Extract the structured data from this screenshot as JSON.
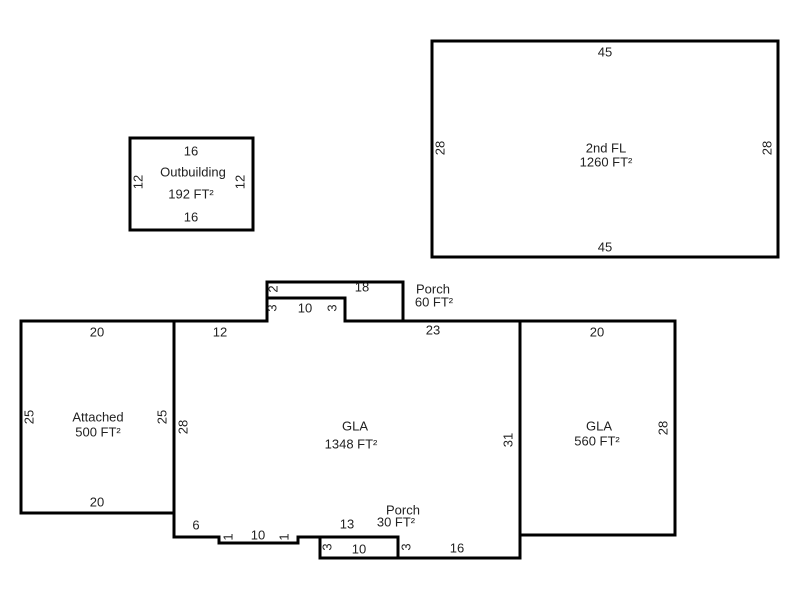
{
  "sketch": {
    "canvas": {
      "width": 800,
      "height": 600,
      "background": "#ffffff"
    },
    "style": {
      "wall_color": "#000000",
      "wall_width": 3,
      "text_color": "#222222",
      "font_size": 13
    },
    "shapes": [
      {
        "id": "second-floor",
        "room_name": "2nd FL",
        "area": "1260 FT²",
        "points": [
          [
            432,
            41
          ],
          [
            778,
            41
          ],
          [
            778,
            257
          ],
          [
            432,
            257
          ]
        ],
        "labels": [
          {
            "text": "45",
            "x": 605,
            "y": 52,
            "rotated": false,
            "kind": "dimension"
          },
          {
            "text": "28",
            "x": 440,
            "y": 148,
            "rotated": true,
            "kind": "dimension"
          },
          {
            "text": "2nd FL",
            "x": 606,
            "y": 148,
            "rotated": false,
            "kind": "room"
          },
          {
            "text": "1260 FT²",
            "x": 606,
            "y": 162,
            "rotated": false,
            "kind": "area"
          },
          {
            "text": "28",
            "x": 767,
            "y": 148,
            "rotated": true,
            "kind": "dimension"
          },
          {
            "text": "45",
            "x": 605,
            "y": 247,
            "rotated": false,
            "kind": "dimension"
          }
        ]
      },
      {
        "id": "outbuilding",
        "room_name": "Outbuilding",
        "area": "192 FT²",
        "points": [
          [
            130,
            138
          ],
          [
            253,
            138
          ],
          [
            253,
            230
          ],
          [
            130,
            230
          ]
        ],
        "labels": [
          {
            "text": "16",
            "x": 191,
            "y": 151,
            "rotated": false,
            "kind": "dimension"
          },
          {
            "text": "12",
            "x": 138,
            "y": 182,
            "rotated": true,
            "kind": "dimension"
          },
          {
            "text": "Outbuilding",
            "x": 193,
            "y": 172,
            "rotated": false,
            "kind": "room"
          },
          {
            "text": "192 FT²",
            "x": 191,
            "y": 194,
            "rotated": false,
            "kind": "area"
          },
          {
            "text": "12",
            "x": 240,
            "y": 182,
            "rotated": true,
            "kind": "dimension"
          },
          {
            "text": "16",
            "x": 191,
            "y": 217,
            "rotated": false,
            "kind": "dimension"
          }
        ]
      },
      {
        "id": "attached",
        "room_name": "Attached",
        "area": "500 FT²",
        "points": [
          [
            21,
            321
          ],
          [
            174,
            321
          ],
          [
            174,
            513
          ],
          [
            21,
            513
          ]
        ],
        "labels": [
          {
            "text": "20",
            "x": 97,
            "y": 332,
            "rotated": false,
            "kind": "dimension"
          },
          {
            "text": "25",
            "x": 29,
            "y": 417,
            "rotated": true,
            "kind": "dimension"
          },
          {
            "text": "Attached",
            "x": 98,
            "y": 417,
            "rotated": false,
            "kind": "room"
          },
          {
            "text": "500 FT²",
            "x": 98,
            "y": 432,
            "rotated": false,
            "kind": "area"
          },
          {
            "text": "25",
            "x": 162,
            "y": 417,
            "rotated": true,
            "kind": "dimension"
          },
          {
            "text": "20",
            "x": 97,
            "y": 502,
            "rotated": false,
            "kind": "dimension"
          }
        ]
      },
      {
        "id": "gla-main",
        "room_name": "GLA",
        "area": "1348 FT²",
        "points": [
          [
            174,
            321
          ],
          [
            267,
            321
          ],
          [
            267,
            298
          ],
          [
            345,
            298
          ],
          [
            345,
            321
          ],
          [
            520,
            321
          ],
          [
            520,
            558
          ],
          [
            398,
            558
          ],
          [
            398,
            537
          ],
          [
            298,
            537
          ],
          [
            298,
            543
          ],
          [
            219,
            543
          ],
          [
            219,
            537
          ],
          [
            174,
            537
          ]
        ],
        "labels": [
          {
            "text": "12",
            "x": 220,
            "y": 332,
            "rotated": false,
            "kind": "dimension"
          },
          {
            "text": "23",
            "x": 433,
            "y": 330,
            "rotated": false,
            "kind": "dimension"
          },
          {
            "text": "28",
            "x": 183,
            "y": 427,
            "rotated": true,
            "kind": "dimension"
          },
          {
            "text": "GLA",
            "x": 355,
            "y": 426,
            "rotated": false,
            "kind": "room"
          },
          {
            "text": "1348 FT²",
            "x": 351,
            "y": 444,
            "rotated": false,
            "kind": "area"
          },
          {
            "text": "31",
            "x": 508,
            "y": 440,
            "rotated": true,
            "kind": "dimension"
          },
          {
            "text": "6",
            "x": 196,
            "y": 525,
            "rotated": false,
            "kind": "dimension"
          },
          {
            "text": "1",
            "x": 228,
            "y": 537,
            "rotated": true,
            "kind": "dimension"
          },
          {
            "text": "10",
            "x": 258,
            "y": 535,
            "rotated": false,
            "kind": "dimension"
          },
          {
            "text": "1",
            "x": 284,
            "y": 537,
            "rotated": true,
            "kind": "dimension"
          },
          {
            "text": "13",
            "x": 347,
            "y": 524,
            "rotated": false,
            "kind": "dimension"
          },
          {
            "text": "3",
            "x": 406,
            "y": 547,
            "rotated": true,
            "kind": "dimension"
          },
          {
            "text": "16",
            "x": 457,
            "y": 548,
            "rotated": false,
            "kind": "dimension"
          }
        ]
      },
      {
        "id": "porch-top",
        "room_name": "Porch",
        "area": "60 FT²",
        "points": [
          [
            267,
            298
          ],
          [
            267,
            282
          ],
          [
            403,
            282
          ],
          [
            403,
            321
          ],
          [
            345,
            321
          ],
          [
            345,
            298
          ]
        ],
        "labels": [
          {
            "text": "2",
            "x": 273,
            "y": 289,
            "rotated": true,
            "kind": "dimension"
          },
          {
            "text": "18",
            "x": 362,
            "y": 287,
            "rotated": false,
            "kind": "dimension"
          },
          {
            "text": "Porch",
            "x": 433,
            "y": 289,
            "rotated": false,
            "kind": "room"
          },
          {
            "text": "60 FT²",
            "x": 434,
            "y": 302,
            "rotated": false,
            "kind": "area"
          },
          {
            "text": "3",
            "x": 272,
            "y": 308,
            "rotated": true,
            "kind": "dimension"
          },
          {
            "text": "10",
            "x": 305,
            "y": 308,
            "rotated": false,
            "kind": "dimension"
          },
          {
            "text": "3",
            "x": 332,
            "y": 308,
            "rotated": true,
            "kind": "dimension"
          }
        ]
      },
      {
        "id": "porch-bottom",
        "room_name": "Porch",
        "area": "30 FT²",
        "points": [
          [
            320,
            537
          ],
          [
            398,
            537
          ],
          [
            398,
            558
          ],
          [
            320,
            558
          ]
        ],
        "labels": [
          {
            "text": "Porch",
            "x": 403,
            "y": 510,
            "rotated": false,
            "kind": "room"
          },
          {
            "text": "30 FT²",
            "x": 396,
            "y": 522,
            "rotated": false,
            "kind": "area"
          },
          {
            "text": "3",
            "x": 327,
            "y": 547,
            "rotated": true,
            "kind": "dimension"
          },
          {
            "text": "10",
            "x": 359,
            "y": 549,
            "rotated": false,
            "kind": "dimension"
          }
        ]
      },
      {
        "id": "gla-right",
        "room_name": "GLA",
        "area": "560 FT²",
        "points": [
          [
            520,
            321
          ],
          [
            675,
            321
          ],
          [
            675,
            535
          ],
          [
            520,
            535
          ]
        ],
        "labels": [
          {
            "text": "20",
            "x": 597,
            "y": 332,
            "rotated": false,
            "kind": "dimension"
          },
          {
            "text": "GLA",
            "x": 599,
            "y": 426,
            "rotated": false,
            "kind": "room"
          },
          {
            "text": "560 FT²",
            "x": 597,
            "y": 441,
            "rotated": false,
            "kind": "area"
          },
          {
            "text": "28",
            "x": 663,
            "y": 428,
            "rotated": true,
            "kind": "dimension"
          }
        ]
      }
    ]
  }
}
